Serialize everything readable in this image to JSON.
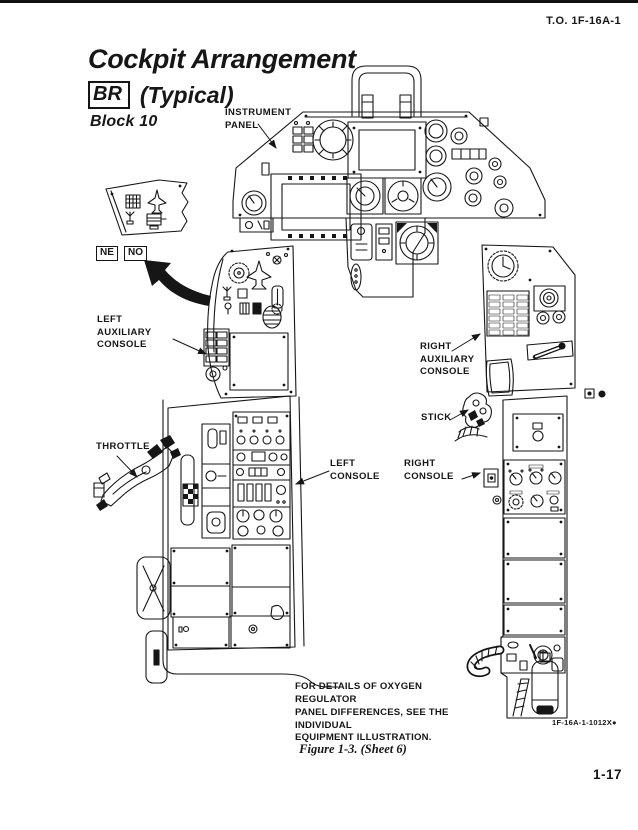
{
  "page": {
    "doc_number": "T.O. 1F-16A-1",
    "page_number": "1-17",
    "figure_caption": "Figure 1-3. (Sheet 6)",
    "figure_code": "1F-16A-1-1012X●"
  },
  "title": {
    "main": "Cockpit Arrangement",
    "badge": "BR",
    "qualifier": "(Typical)",
    "block": "Block 10"
  },
  "inset": {
    "badge_left": "NE",
    "badge_right": "NO"
  },
  "callouts": {
    "instrument_panel": "INSTRUMENT\nPANEL",
    "left_aux_console": "LEFT\nAUXILIARY\nCONSOLE",
    "throttle": "THROTTLE",
    "left_console": "LEFT\nCONSOLE",
    "right_console": "RIGHT\nCONSOLE",
    "right_aux_console": "RIGHT\nAUXILIARY\nCONSOLE",
    "stick": "STICK"
  },
  "note": "FOR DETAILS OF OXYGEN REGULATOR\nPANEL DIFFERENCES, SEE THE INDIVIDUAL\nEQUIPMENT ILLUSTRATION.",
  "colors": {
    "ink": "#161616",
    "paper": "#ffffff"
  }
}
